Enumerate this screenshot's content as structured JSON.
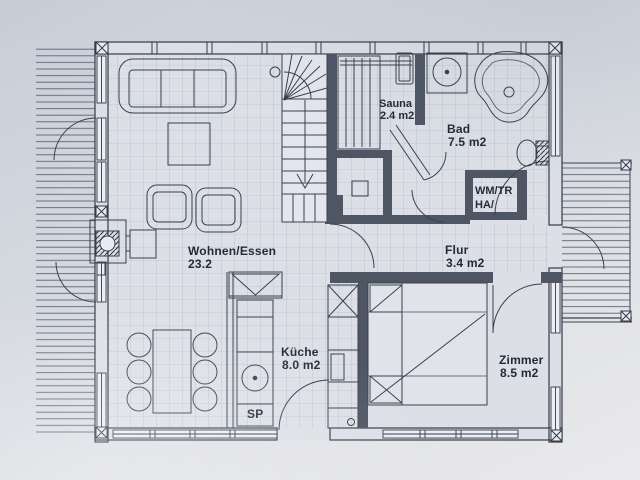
{
  "plan": {
    "rooms": {
      "wohnen_essen": {
        "name": "Wohnen/Essen",
        "area": "23.2"
      },
      "sauna": {
        "name": "Sauna",
        "area": "2.4 m2"
      },
      "bad": {
        "name": "Bad",
        "area": "7.5 m2"
      },
      "flur": {
        "name": "Flur",
        "area": "3.4 m2"
      },
      "kueche": {
        "name": "Küche",
        "area": "8.0 m2"
      },
      "zimmer": {
        "name": "Zimmer",
        "area": "8.5 m2"
      },
      "utility": {
        "line1": "WM/TR",
        "line2": "HA/"
      }
    },
    "labels": {
      "sink": "SP"
    },
    "colors": {
      "paper": "#d9dce2",
      "ink": "#323b49",
      "wall_fill": "#4e5664",
      "tile_line": "#9fabbe",
      "plank_line": "#5a6475"
    }
  }
}
